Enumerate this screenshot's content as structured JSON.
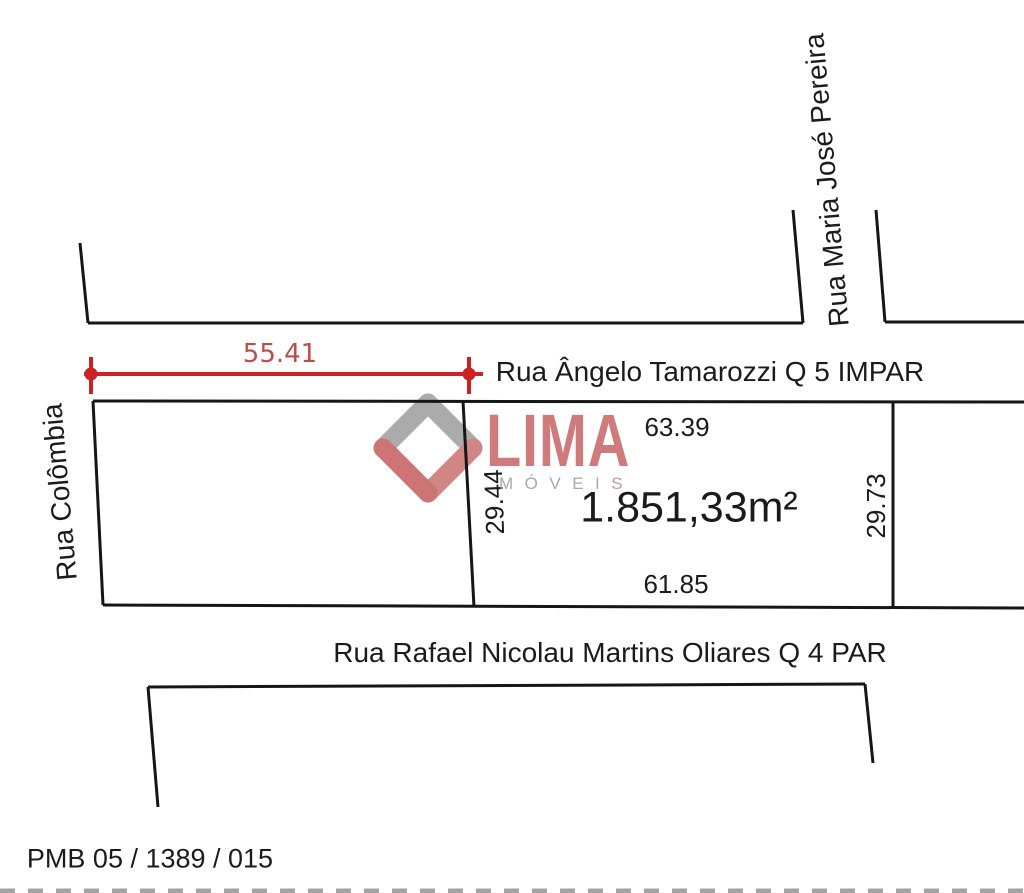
{
  "diagram": {
    "streets": {
      "top": "Rua Ângelo Tamarozzi Q 5 IMPAR",
      "right": "Rua Maria José Pereira",
      "left": "Rua Colômbia",
      "bottom": "Rua Rafael Nicolau Martins Oliares Q 4 PAR"
    },
    "lot": {
      "area_label": "1.851,33m²",
      "front_width": "55.41",
      "side_top": "63.39",
      "side_left": "29.44",
      "side_right": "29.73",
      "side_bottom": "61.85"
    },
    "registry_code": "PMB 05 / 1389 / 015",
    "watermark": {
      "brand": "LIMA",
      "subtitle_prefix": "MÓVEI",
      "subtitle_suffix": "S"
    },
    "colors": {
      "outline_black": "#161616",
      "dimension_line_red": "#cc2222",
      "dimension_text_red": "#c14b4b",
      "logo_red": "#c55c5c",
      "logo_light_red": "#c97272",
      "logo_gray": "#9d9d9d",
      "edge_dash_gray": "#7d7d7d"
    }
  }
}
